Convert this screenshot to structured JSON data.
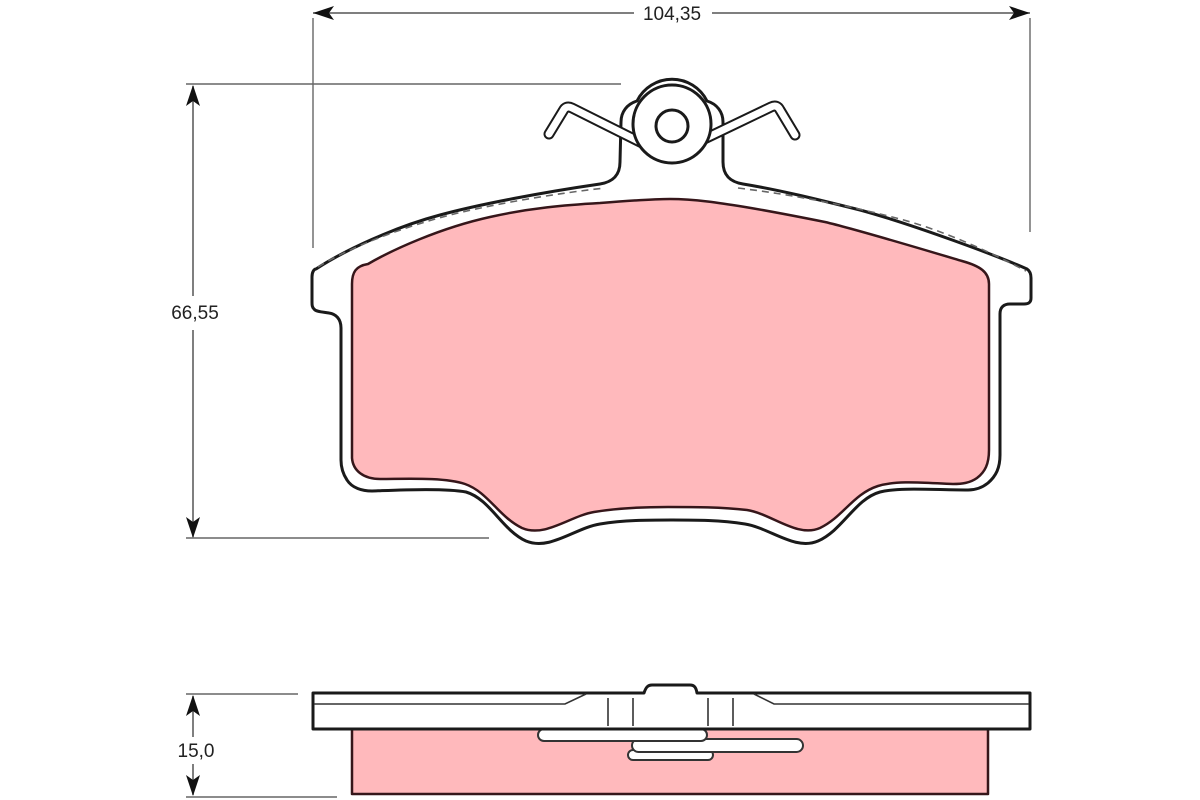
{
  "drawing": {
    "labels": {
      "width": "104,35",
      "height": "66,55",
      "thickness": "15,0"
    },
    "colors": {
      "friction_material": "#FFB9BC",
      "plate_outline": "#1a1a1a",
      "pad_outline": "#36161a",
      "dimension_line": "#555555",
      "text": "#222222",
      "background": "#ffffff"
    }
  }
}
